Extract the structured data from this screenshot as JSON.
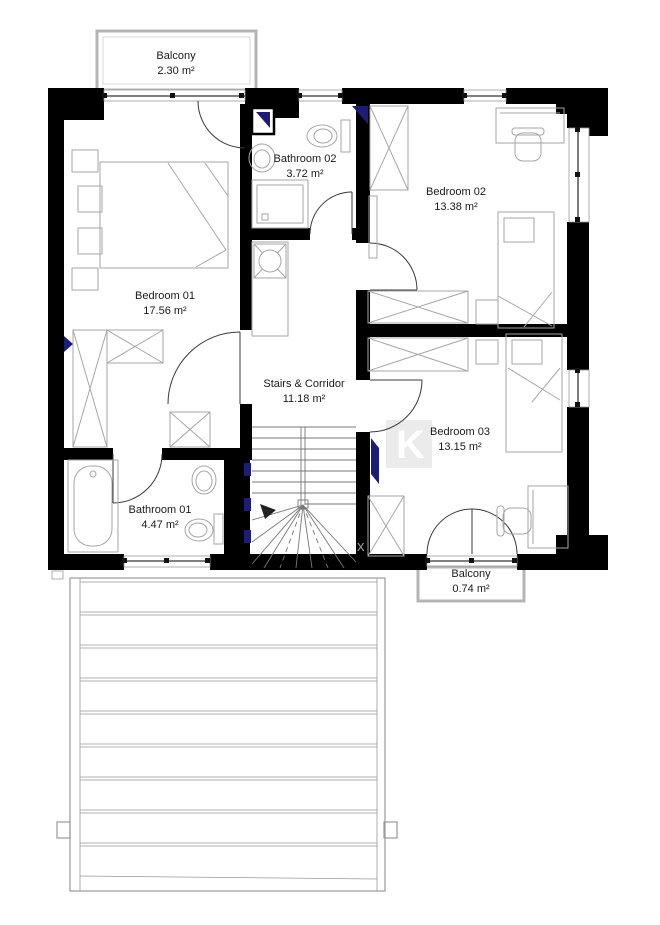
{
  "plan": {
    "rooms": [
      {
        "name": "Balcony",
        "area": "2.30 m²"
      },
      {
        "name": "Bathroom 02",
        "area": "3.72 m²"
      },
      {
        "name": "Bedroom 02",
        "area": "13.38 m²"
      },
      {
        "name": "Bedroom 01",
        "area": "17.56 m²"
      },
      {
        "name": "Stairs & Corridor",
        "area": "11.18 m²"
      },
      {
        "name": "Bedroom 03",
        "area": "13.15 m²"
      },
      {
        "name": "Bathroom 01",
        "area": "4.47 m²"
      },
      {
        "name": "Balcony",
        "area": "0.74 m²"
      }
    ],
    "watermark": {
      "k": "K",
      "x": "x"
    },
    "colors": {
      "wall": "#000000",
      "accent_blue": "#1d1d78",
      "furniture_line": "#a6a6a6",
      "balcony_trim": "#b5b5b5",
      "text": "#1a1a1a",
      "stair_line": "#777777",
      "terrace_line": "#999999",
      "window_line": "#333333"
    }
  }
}
